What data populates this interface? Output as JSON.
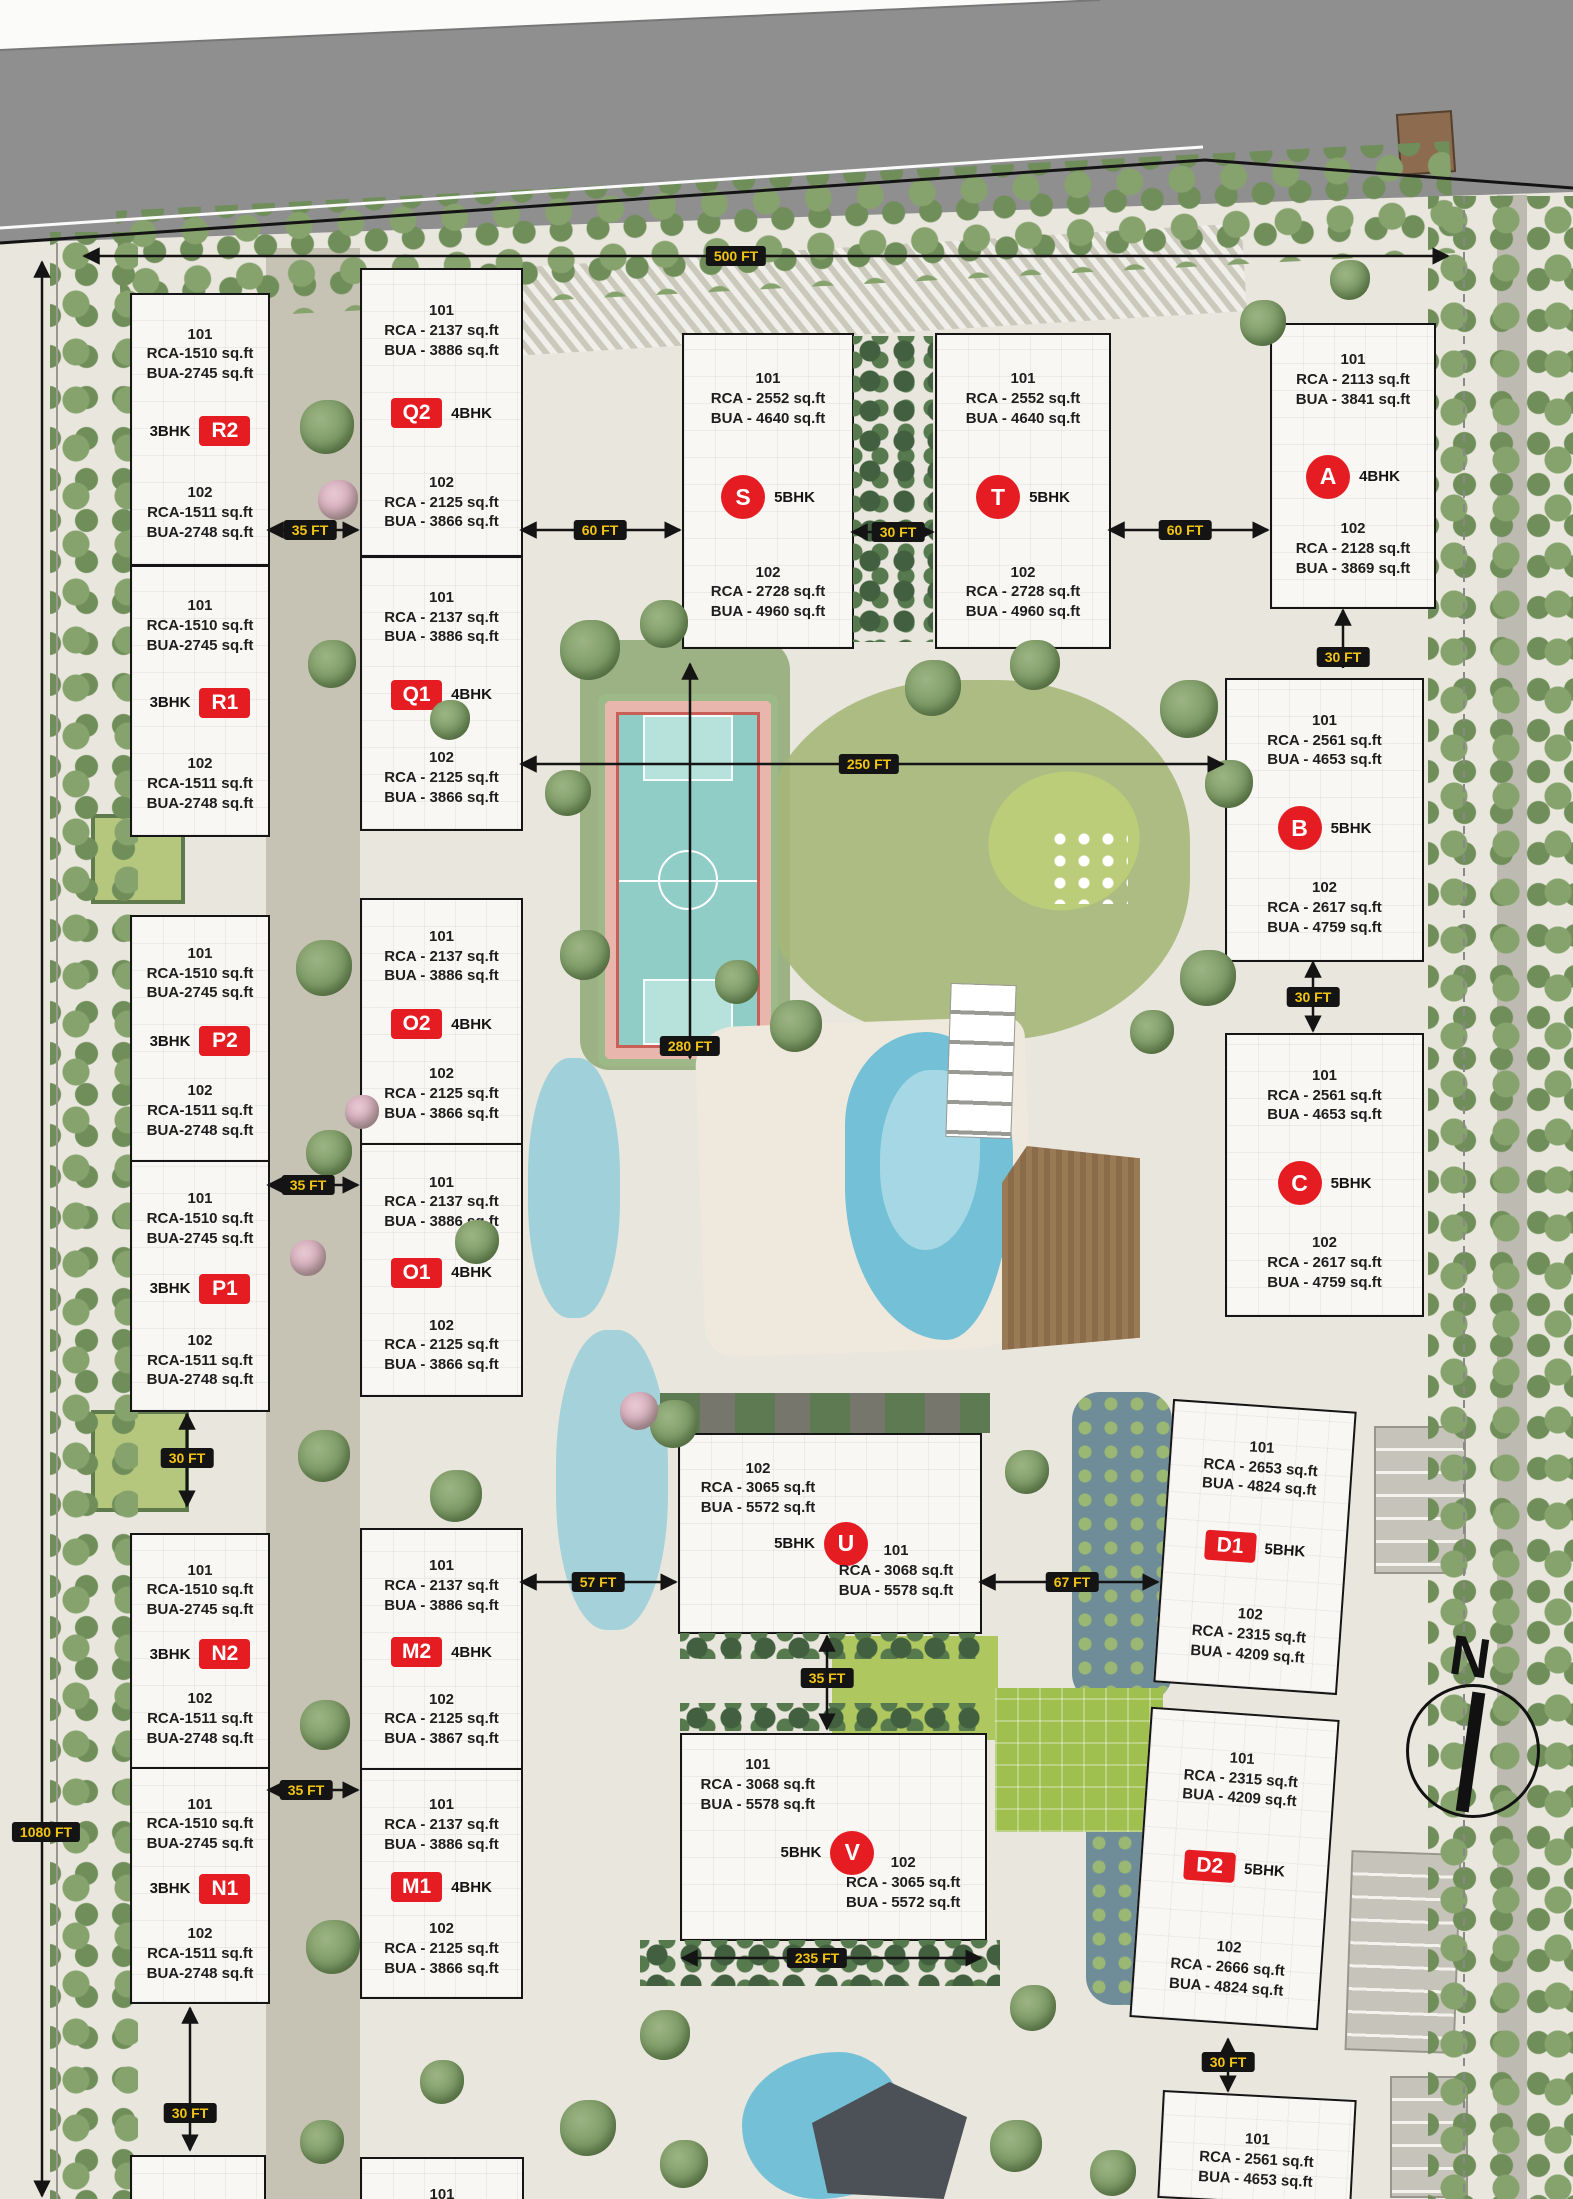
{
  "colors": {
    "badge_red": "#e51d23",
    "chip_bg": "#141414",
    "chip_text": "#f2c412",
    "road_gray": "#8f8f8f",
    "court_teal": "#8fcdc6",
    "pool_blue": "#74c0d6",
    "building_fill": "#f8f7f3"
  },
  "compass": {
    "label": "N"
  },
  "dims": {
    "d500": "500 FT",
    "d1080": "1080 FT",
    "d35a": "35 FT",
    "d60a": "60 FT",
    "d30a": "30 FT",
    "d60b": "60 FT",
    "d30b": "30 FT",
    "d250": "250 FT",
    "d30c": "30 FT",
    "d280": "280 FT",
    "d35b": "35 FT",
    "d30d": "30 FT",
    "d57": "57 FT",
    "d67": "67 FT",
    "d35c": "35 FT",
    "d35d": "35 FT",
    "d235": "235 FT",
    "d30e": "30 FT",
    "d30f": "30 FT"
  },
  "buildings": {
    "r2": {
      "bhk": "3BHK",
      "badge": "R2",
      "u1": {
        "no": "101",
        "rca": "RCA-1510 sq.ft",
        "bua": "BUA-2745 sq.ft"
      },
      "u2": {
        "no": "102",
        "rca": "RCA-1511 sq.ft",
        "bua": "BUA-2748 sq.ft"
      }
    },
    "r1": {
      "bhk": "3BHK",
      "badge": "R1",
      "u1": {
        "no": "101",
        "rca": "RCA-1510 sq.ft",
        "bua": "BUA-2745 sq.ft"
      },
      "u2": {
        "no": "102",
        "rca": "RCA-1511 sq.ft",
        "bua": "BUA-2748 sq.ft"
      }
    },
    "p2": {
      "bhk": "3BHK",
      "badge": "P2",
      "u1": {
        "no": "101",
        "rca": "RCA-1510 sq.ft",
        "bua": "BUA-2745 sq.ft"
      },
      "u2": {
        "no": "102",
        "rca": "RCA-1511 sq.ft",
        "bua": "BUA-2748 sq.ft"
      }
    },
    "p1": {
      "bhk": "3BHK",
      "badge": "P1",
      "u1": {
        "no": "101",
        "rca": "RCA-1510 sq.ft",
        "bua": "BUA-2745 sq.ft"
      },
      "u2": {
        "no": "102",
        "rca": "RCA-1511 sq.ft",
        "bua": "BUA-2748 sq.ft"
      }
    },
    "n2": {
      "bhk": "3BHK",
      "badge": "N2",
      "u1": {
        "no": "101",
        "rca": "RCA-1510 sq.ft",
        "bua": "BUA-2745 sq.ft"
      },
      "u2": {
        "no": "102",
        "rca": "RCA-1511 sq.ft",
        "bua": "BUA-2748 sq.ft"
      }
    },
    "n1": {
      "bhk": "3BHK",
      "badge": "N1",
      "u1": {
        "no": "101",
        "rca": "RCA-1510 sq.ft",
        "bua": "BUA-2745 sq.ft"
      },
      "u2": {
        "no": "102",
        "rca": "RCA-1511 sq.ft",
        "bua": "BUA-2748 sq.ft"
      }
    },
    "q2": {
      "bhk": "4BHK",
      "badge": "Q2",
      "u1": {
        "no": "101",
        "rca": "RCA - 2137 sq.ft",
        "bua": "BUA - 3886 sq.ft"
      },
      "u2": {
        "no": "102",
        "rca": "RCA - 2125 sq.ft",
        "bua": "BUA - 3866 sq.ft"
      }
    },
    "q1": {
      "bhk": "4BHK",
      "badge": "Q1",
      "u1": {
        "no": "101",
        "rca": "RCA - 2137 sq.ft",
        "bua": "BUA - 3886 sq.ft"
      },
      "u2": {
        "no": "102",
        "rca": "RCA - 2125 sq.ft",
        "bua": "BUA - 3866 sq.ft"
      }
    },
    "o2": {
      "bhk": "4BHK",
      "badge": "O2",
      "u1": {
        "no": "101",
        "rca": "RCA - 2137 sq.ft",
        "bua": "BUA - 3886 sq.ft"
      },
      "u2": {
        "no": "102",
        "rca": "RCA - 2125 sq.ft",
        "bua": "BUA - 3866 sq.ft"
      }
    },
    "o1": {
      "bhk": "4BHK",
      "badge": "O1",
      "u1": {
        "no": "101",
        "rca": "RCA - 2137 sq.ft",
        "bua": "BUA - 3886 sq.ft"
      },
      "u2": {
        "no": "102",
        "rca": "RCA - 2125 sq.ft",
        "bua": "BUA - 3866 sq.ft"
      }
    },
    "m2": {
      "bhk": "4BHK",
      "badge": "M2",
      "u1": {
        "no": "101",
        "rca": "RCA - 2137 sq.ft",
        "bua": "BUA - 3886 sq.ft"
      },
      "u2": {
        "no": "102",
        "rca": "RCA - 2125 sq.ft",
        "bua": "BUA - 3867 sq.ft"
      }
    },
    "m1": {
      "bhk": "4BHK",
      "badge": "M1",
      "u1": {
        "no": "101",
        "rca": "RCA - 2137 sq.ft",
        "bua": "BUA - 3886 sq.ft"
      },
      "u2": {
        "no": "102",
        "rca": "RCA - 2125 sq.ft",
        "bua": "BUA - 3866 sq.ft"
      }
    },
    "s": {
      "bhk": "5BHK",
      "badge": "S",
      "u1": {
        "no": "101",
        "rca": "RCA - 2552 sq.ft",
        "bua": "BUA - 4640 sq.ft"
      },
      "u2": {
        "no": "102",
        "rca": "RCA - 2728 sq.ft",
        "bua": "BUA - 4960 sq.ft"
      }
    },
    "t": {
      "bhk": "5BHK",
      "badge": "T",
      "u1": {
        "no": "101",
        "rca": "RCA - 2552 sq.ft",
        "bua": "BUA - 4640 sq.ft"
      },
      "u2": {
        "no": "102",
        "rca": "RCA - 2728 sq.ft",
        "bua": "BUA - 4960 sq.ft"
      }
    },
    "a": {
      "bhk": "4BHK",
      "badge": "A",
      "u1": {
        "no": "101",
        "rca": "RCA - 2113 sq.ft",
        "bua": "BUA - 3841 sq.ft"
      },
      "u2": {
        "no": "102",
        "rca": "RCA - 2128 sq.ft",
        "bua": "BUA - 3869 sq.ft"
      }
    },
    "b": {
      "bhk": "5BHK",
      "badge": "B",
      "u1": {
        "no": "101",
        "rca": "RCA - 2561 sq.ft",
        "bua": "BUA - 4653 sq.ft"
      },
      "u2": {
        "no": "102",
        "rca": "RCA - 2617 sq.ft",
        "bua": "BUA - 4759 sq.ft"
      }
    },
    "c": {
      "bhk": "5BHK",
      "badge": "C",
      "u1": {
        "no": "101",
        "rca": "RCA - 2561 sq.ft",
        "bua": "BUA - 4653 sq.ft"
      },
      "u2": {
        "no": "102",
        "rca": "RCA - 2617 sq.ft",
        "bua": "BUA - 4759 sq.ft"
      }
    },
    "u": {
      "bhk": "5BHK",
      "badge": "U",
      "u1": {
        "no": "102",
        "rca": "RCA - 3065 sq.ft",
        "bua": "BUA - 5572 sq.ft"
      },
      "u2": {
        "no": "101",
        "rca": "RCA - 3068 sq.ft",
        "bua": "BUA - 5578 sq.ft"
      }
    },
    "v": {
      "bhk": "5BHK",
      "badge": "V",
      "u1": {
        "no": "101",
        "rca": "RCA - 3068 sq.ft",
        "bua": "BUA - 5578 sq.ft"
      },
      "u2": {
        "no": "102",
        "rca": "RCA - 3065 sq.ft",
        "bua": "BUA - 5572 sq.ft"
      }
    },
    "d1": {
      "bhk": "5BHK",
      "badge": "D1",
      "u1": {
        "no": "101",
        "rca": "RCA - 2653 sq.ft",
        "bua": "BUA - 4824 sq.ft"
      },
      "u2": {
        "no": "102",
        "rca": "RCA - 2315 sq.ft",
        "bua": "BUA - 4209 sq.ft"
      }
    },
    "d2": {
      "bhk": "5BHK",
      "badge": "D2",
      "u1": {
        "no": "101",
        "rca": "RCA - 2315 sq.ft",
        "bua": "BUA - 4209 sq.ft"
      },
      "u2": {
        "no": "102",
        "rca": "RCA - 2666 sq.ft",
        "bua": "BUA - 4824 sq.ft"
      }
    },
    "e1": {
      "u1": {
        "no": "101",
        "rca": "RCA - 2561 sq.ft",
        "bua": "BUA - 4653 sq.ft"
      }
    },
    "m0": {
      "u1": {
        "no": "101"
      }
    }
  }
}
